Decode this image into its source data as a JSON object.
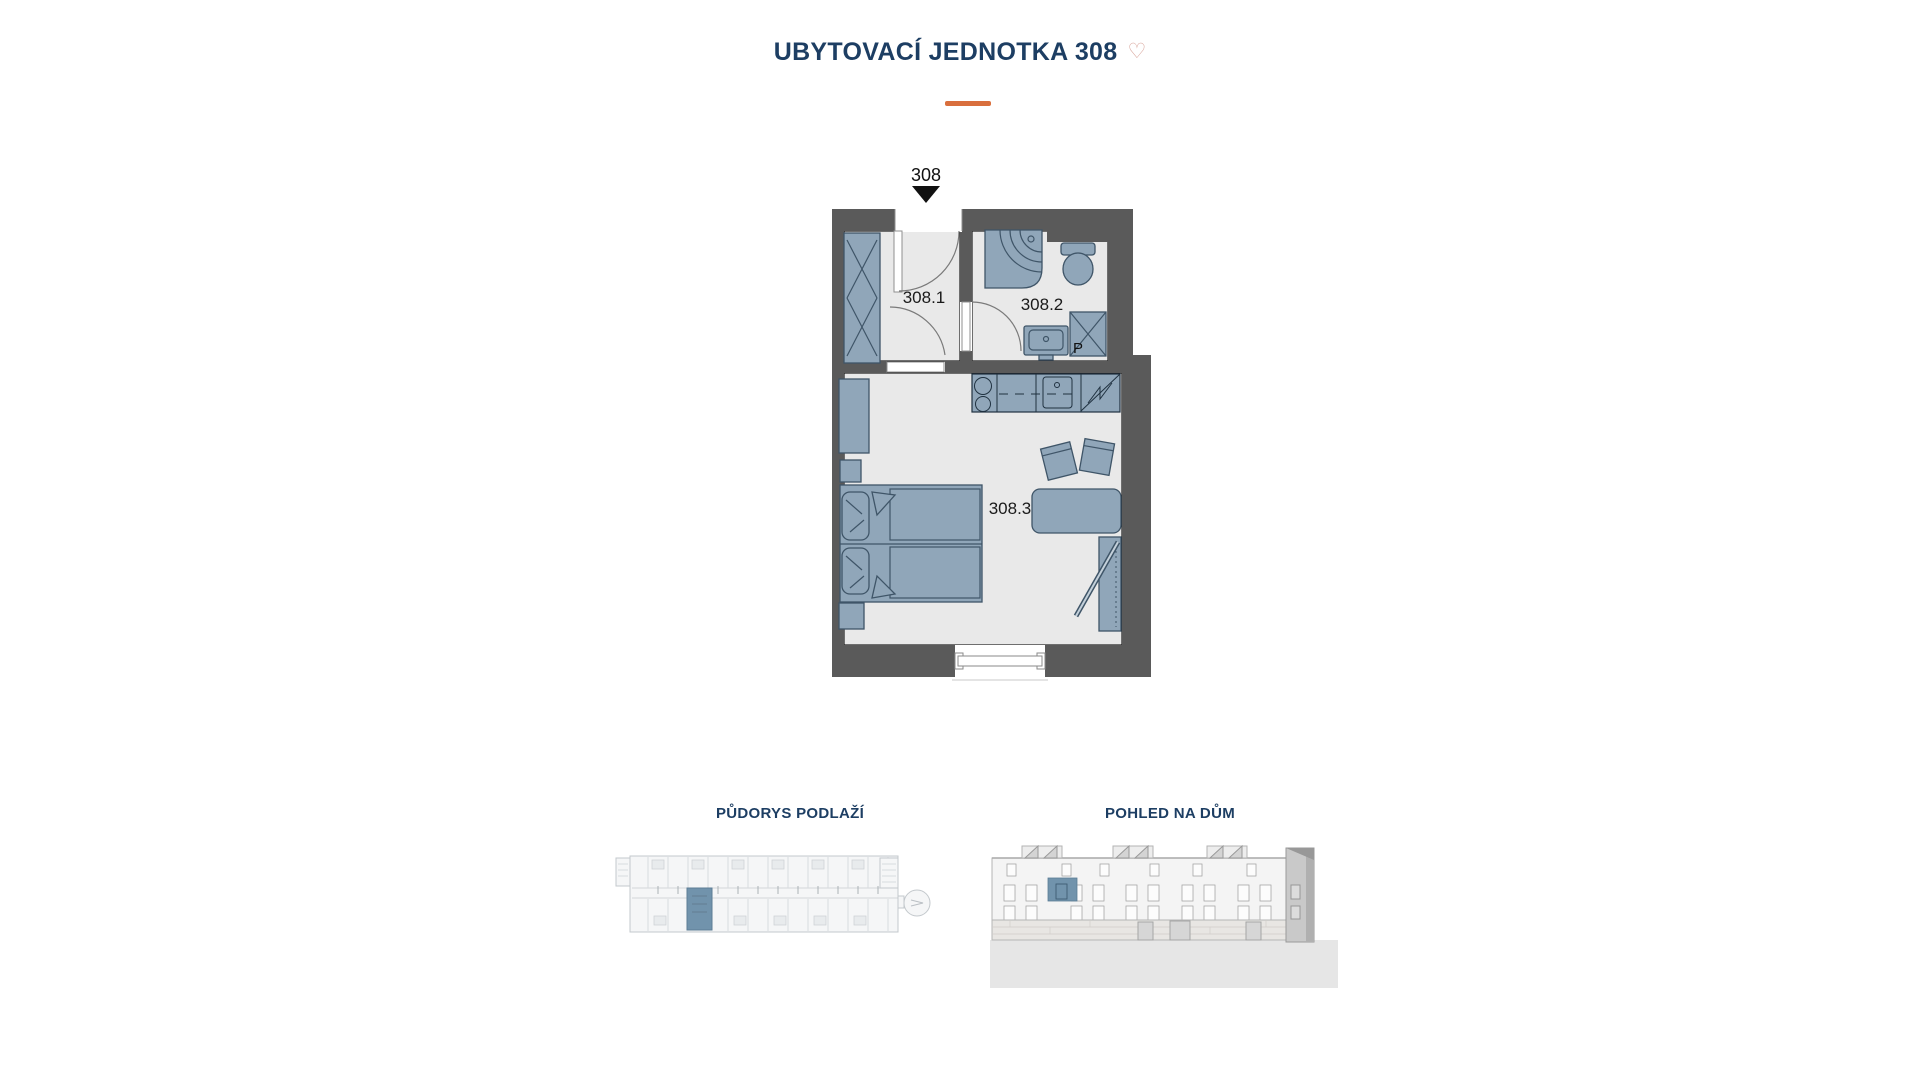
{
  "header": {
    "title": "UBYTOVACÍ JEDNOTKA 308",
    "favorite_icon": "♡"
  },
  "floor_plan": {
    "entrance_label": "308",
    "room_labels": {
      "hall": "308.1",
      "bathroom": "308.2",
      "living": "308.3"
    },
    "washer_label": "P"
  },
  "thumbnails": {
    "storey_plan_label": "PŮDORYS PODLAŽÍ",
    "building_view_label": "POHLED NA DŮM"
  },
  "colors": {
    "title": "#1d3e63",
    "accent": "#d96f3d",
    "heart": "#d8a49a",
    "wall": "#5a5a5a",
    "floor": "#e9e9e9",
    "furniture": "#90a6b9",
    "furniture_line": "#3f5568",
    "highlight": "#7193ac",
    "label": "#1a1a1a"
  }
}
